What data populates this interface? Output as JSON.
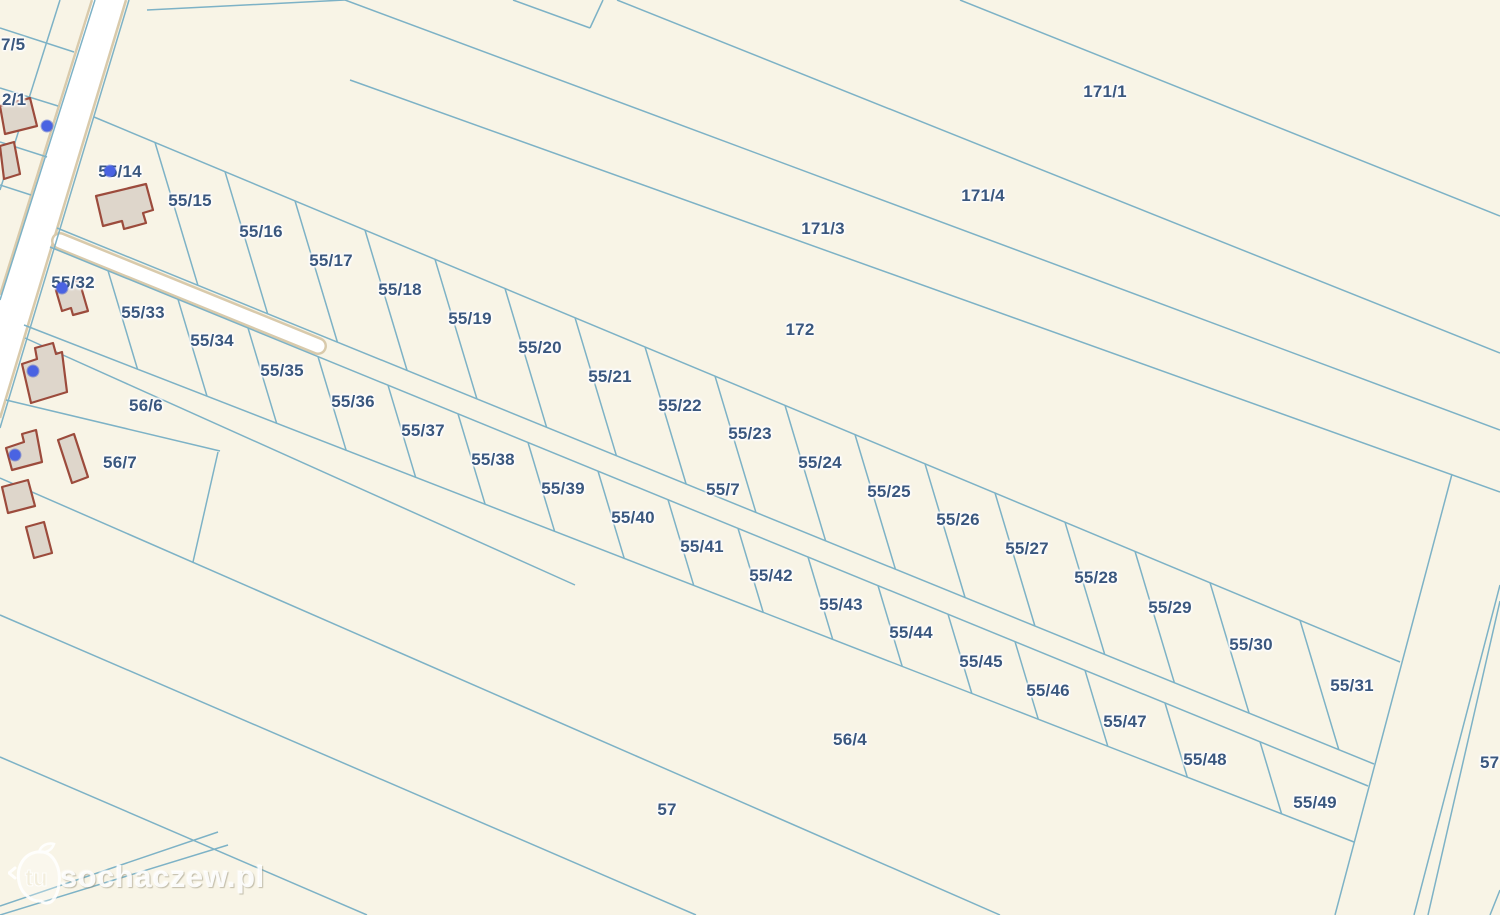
{
  "watermark": {
    "tu_badge": "tu",
    "site": "sochaczew.pl"
  },
  "colors": {
    "background": "#f8f4e6",
    "parcel_line": "#7db2c6",
    "label_text": "#3a577e",
    "building_fill": "#ded6cb",
    "building_stroke": "#9c4b3c",
    "road_fill": "#ffffff",
    "road_casing": "#d9caab",
    "address_dot": "#4a63e2"
  },
  "parcels": {
    "upper_row": [
      {
        "id": "55/14",
        "x": 120,
        "y": 172
      },
      {
        "id": "55/15",
        "x": 190,
        "y": 201
      },
      {
        "id": "55/16",
        "x": 261,
        "y": 232
      },
      {
        "id": "55/17",
        "x": 331,
        "y": 261
      },
      {
        "id": "55/18",
        "x": 400,
        "y": 290
      },
      {
        "id": "55/19",
        "x": 470,
        "y": 319
      },
      {
        "id": "55/20",
        "x": 540,
        "y": 348
      },
      {
        "id": "55/21",
        "x": 610,
        "y": 377
      },
      {
        "id": "55/22",
        "x": 680,
        "y": 406
      },
      {
        "id": "55/23",
        "x": 750,
        "y": 434
      },
      {
        "id": "55/24",
        "x": 820,
        "y": 463
      },
      {
        "id": "55/25",
        "x": 889,
        "y": 492
      },
      {
        "id": "55/26",
        "x": 958,
        "y": 520
      },
      {
        "id": "55/27",
        "x": 1027,
        "y": 549
      },
      {
        "id": "55/28",
        "x": 1096,
        "y": 578
      },
      {
        "id": "55/29",
        "x": 1170,
        "y": 608
      },
      {
        "id": "55/30",
        "x": 1251,
        "y": 645
      },
      {
        "id": "55/31",
        "x": 1352,
        "y": 686
      }
    ],
    "lower_row": [
      {
        "id": "55/32",
        "x": 73,
        "y": 283
      },
      {
        "id": "55/33",
        "x": 143,
        "y": 313
      },
      {
        "id": "55/34",
        "x": 212,
        "y": 341
      },
      {
        "id": "55/35",
        "x": 282,
        "y": 371
      },
      {
        "id": "55/36",
        "x": 353,
        "y": 402
      },
      {
        "id": "55/37",
        "x": 423,
        "y": 431
      },
      {
        "id": "55/38",
        "x": 493,
        "y": 460
      },
      {
        "id": "55/39",
        "x": 563,
        "y": 489
      },
      {
        "id": "55/40",
        "x": 633,
        "y": 518
      },
      {
        "id": "55/41",
        "x": 702,
        "y": 547
      },
      {
        "id": "55/42",
        "x": 771,
        "y": 576
      },
      {
        "id": "55/43",
        "x": 841,
        "y": 605
      },
      {
        "id": "55/44",
        "x": 911,
        "y": 633
      },
      {
        "id": "55/45",
        "x": 981,
        "y": 662
      },
      {
        "id": "55/46",
        "x": 1048,
        "y": 691
      },
      {
        "id": "55/47",
        "x": 1125,
        "y": 722
      },
      {
        "id": "55/48",
        "x": 1205,
        "y": 760
      },
      {
        "id": "55/49",
        "x": 1315,
        "y": 803
      }
    ],
    "large": [
      {
        "id": "171/1",
        "x": 1105,
        "y": 92
      },
      {
        "id": "171/4",
        "x": 983,
        "y": 196
      },
      {
        "id": "171/3",
        "x": 823,
        "y": 229
      },
      {
        "id": "172",
        "x": 800,
        "y": 330
      },
      {
        "id": "55/7",
        "x": 723,
        "y": 490
      },
      {
        "id": "56/6",
        "x": 146,
        "y": 406
      },
      {
        "id": "56/7",
        "x": 120,
        "y": 463
      },
      {
        "id": "56/4",
        "x": 850,
        "y": 740
      },
      {
        "id": "57",
        "x": 667,
        "y": 810
      }
    ],
    "edge_left": [
      {
        "id": "7/5",
        "x": 1,
        "y": 45
      },
      {
        "id": "2/1",
        "x": 2,
        "y": 100
      }
    ],
    "edge_right": [
      {
        "id": "57",
        "x": 1480,
        "y": 763
      }
    ]
  }
}
